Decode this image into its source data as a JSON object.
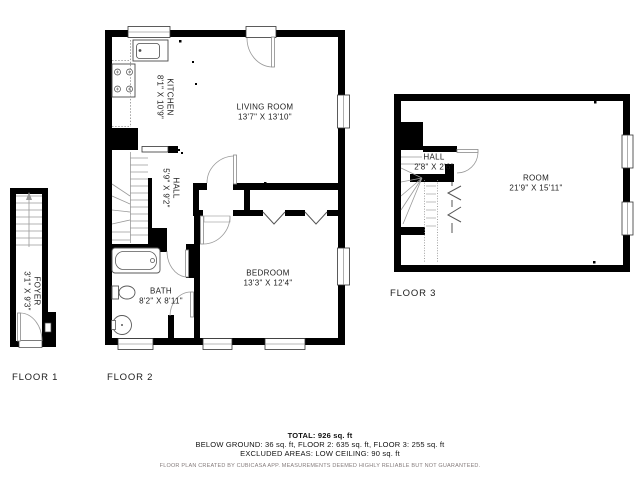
{
  "floors": [
    {
      "label": "FLOOR 1",
      "rooms": [
        {
          "name": "FOYER",
          "dims": "3'1\" X 9'3\""
        }
      ]
    },
    {
      "label": "FLOOR 2",
      "rooms": [
        {
          "name": "KITCHEN",
          "dims": "8'1\" X 10'9\""
        },
        {
          "name": "LIVING ROOM",
          "dims": "13'7\" X 13'10\""
        },
        {
          "name": "HALL",
          "dims": "5'9\" X 9'2\""
        },
        {
          "name": "BATH",
          "dims": "8'2\" X 8'11\""
        },
        {
          "name": "BEDROOM",
          "dims": "13'3\" X 12'4\""
        }
      ]
    },
    {
      "label": "FLOOR 3",
      "rooms": [
        {
          "name": "HALL",
          "dims": "2'8\" X 2'6\""
        },
        {
          "name": "ROOM",
          "dims": "21'9\" X 15'11\""
        }
      ]
    }
  ],
  "summary": {
    "total": "TOTAL: 926 sq. ft",
    "areas": "BELOW GROUND: 36 sq. ft, FLOOR 2: 635 sq. ft, FLOOR 3: 255 sq. ft",
    "excluded": "EXCLUDED AREAS: LOW CEILING: 90 sq. ft",
    "disclaimer": "FLOOR PLAN CREATED BY CUBICASA APP. MEASUREMENTS DEEMED HIGHLY RELIABLE BUT NOT GUARANTEED."
  },
  "colors": {
    "wall": "#000000",
    "thin_line": "#3d3d3d",
    "door": "#9a9a9a",
    "stairs": "#9a9a9a",
    "text": "#1c1c1c",
    "muted": "#857c7c"
  }
}
